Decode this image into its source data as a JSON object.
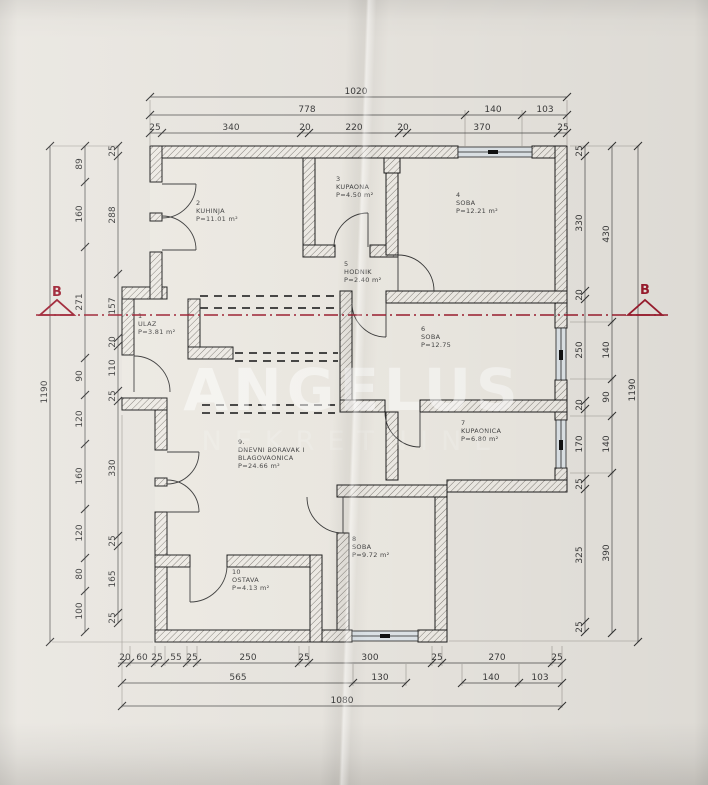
{
  "watermark": {
    "title": "ANGELUS",
    "subtitle": "NEKRETNINE"
  },
  "section": {
    "label_left": "B",
    "label_right": "B",
    "color": "#9c1c2e"
  },
  "rooms": [
    {
      "num": "1",
      "name": "ULAZ",
      "area": "P=3.81 m²",
      "x": 138,
      "y": 318
    },
    {
      "num": "2",
      "name": "KUHINJA",
      "area": "P=11.01 m²",
      "x": 196,
      "y": 205
    },
    {
      "num": "3",
      "name": "KUPAONA",
      "area": "P=4.50 m²",
      "x": 336,
      "y": 181
    },
    {
      "num": "4",
      "name": "SOBA",
      "area": "P=12.21 m²",
      "x": 456,
      "y": 197
    },
    {
      "num": "5",
      "name": "HODNIK",
      "area": "P=2.40 m²",
      "x": 344,
      "y": 266
    },
    {
      "num": "6",
      "name": "SOBA",
      "area": "P=12.75",
      "x": 421,
      "y": 331
    },
    {
      "num": "7",
      "name": "KUPAONICA",
      "area": "P=6.80 m²",
      "x": 461,
      "y": 425
    },
    {
      "num": "8",
      "name": "SOBA",
      "area": "P=9.72 m²",
      "x": 352,
      "y": 541
    },
    {
      "num": "9.",
      "name": "DNEVNI BORAVAK I",
      "name2": "BLAGOVAONICA",
      "area": "P=24.66 m²",
      "x": 238,
      "y": 444
    },
    {
      "num": "10",
      "name": "OSTAVA",
      "area": "P=4.13 m²",
      "x": 232,
      "y": 574
    }
  ],
  "dimensions": {
    "chains": [
      {
        "dir": "h",
        "axis": 97,
        "from": 150,
        "to": 567,
        "ticks": [
          150,
          567
        ],
        "labels": [
          {
            "t": "1020",
            "p": 356
          }
        ]
      },
      {
        "dir": "h",
        "axis": 115,
        "from": 150,
        "to": 567,
        "ticks": [
          150,
          465,
          522,
          567
        ],
        "labels": [
          {
            "t": "778",
            "p": 307
          },
          {
            "t": "140",
            "p": 493
          },
          {
            "t": "103",
            "p": 545
          }
        ]
      },
      {
        "dir": "h",
        "axis": 133,
        "from": 150,
        "to": 567,
        "ticks": [
          150,
          162,
          301,
          309,
          399,
          407,
          558,
          567
        ],
        "labels": [
          {
            "t": "25",
            "p": 155
          },
          {
            "t": "340",
            "p": 231
          },
          {
            "t": "20",
            "p": 305
          },
          {
            "t": "220",
            "p": 354
          },
          {
            "t": "20",
            "p": 403
          },
          {
            "t": "370",
            "p": 482
          },
          {
            "t": "25",
            "p": 563
          }
        ]
      },
      {
        "dir": "h",
        "axis": 663,
        "from": 118,
        "to": 562,
        "ticks": [
          122,
          130,
          155,
          165,
          187,
          197,
          299,
          309,
          432,
          442,
          552,
          562
        ],
        "labels": [
          {
            "t": "20",
            "p": 125
          },
          {
            "t": "60",
            "p": 142
          },
          {
            "t": "25",
            "p": 157
          },
          {
            "t": "55",
            "p": 176
          },
          {
            "t": "25",
            "p": 192
          },
          {
            "t": "250",
            "p": 248
          },
          {
            "t": "25",
            "p": 304
          },
          {
            "t": "300",
            "p": 370
          },
          {
            "t": "25",
            "p": 437
          },
          {
            "t": "270",
            "p": 497
          },
          {
            "t": "25",
            "p": 557
          }
        ]
      },
      {
        "dir": "h",
        "axis": 683,
        "from": 122,
        "to": 406,
        "ticks": [
          122,
          353,
          406
        ],
        "labels": [
          {
            "t": "565",
            "p": 238
          },
          {
            "t": "130",
            "p": 380
          }
        ]
      },
      {
        "dir": "h",
        "axis": 683,
        "from": 462,
        "to": 562,
        "ticks": [
          462,
          519,
          562
        ],
        "labels": [
          {
            "t": "140",
            "p": 491
          },
          {
            "t": "103",
            "p": 540
          }
        ]
      },
      {
        "dir": "h",
        "axis": 706,
        "from": 122,
        "to": 562,
        "ticks": [
          122,
          562
        ],
        "labels": [
          {
            "t": "1080",
            "p": 342
          }
        ]
      },
      {
        "dir": "v",
        "axis": 50,
        "from": 146,
        "to": 642,
        "ticks": [
          146,
          642
        ],
        "labels": [
          {
            "t": "1190",
            "p": 392
          }
        ]
      },
      {
        "dir": "v",
        "axis": 85,
        "from": 146,
        "to": 632,
        "ticks": [
          146,
          182,
          247,
          358,
          395,
          444,
          509,
          558,
          591,
          632
        ],
        "labels": [
          {
            "t": "89",
            "p": 164
          },
          {
            "t": "160",
            "p": 214
          },
          {
            "t": "271",
            "p": 302
          },
          {
            "t": "90",
            "p": 376
          },
          {
            "t": "120",
            "p": 419
          },
          {
            "t": "160",
            "p": 476
          },
          {
            "t": "120",
            "p": 533
          },
          {
            "t": "80",
            "p": 574
          },
          {
            "t": "100",
            "p": 611
          }
        ]
      },
      {
        "dir": "v",
        "axis": 118,
        "from": 146,
        "to": 623,
        "ticks": [
          146,
          156,
          274,
          338,
          346,
          391,
          401,
          536,
          546,
          613,
          623
        ],
        "labels": [
          {
            "t": "25",
            "p": 151
          },
          {
            "t": "288",
            "p": 215
          },
          {
            "t": "157",
            "p": 306
          },
          {
            "t": "20",
            "p": 342
          },
          {
            "t": "110",
            "p": 368
          },
          {
            "t": "25",
            "p": 396
          },
          {
            "t": "330",
            "p": 468
          },
          {
            "t": "25",
            "p": 541
          },
          {
            "t": "165",
            "p": 579
          },
          {
            "t": "25",
            "p": 618
          }
        ]
      },
      {
        "dir": "v",
        "axis": 585,
        "from": 146,
        "to": 632,
        "ticks": [
          146,
          156,
          291,
          299,
          401,
          409,
          479,
          489,
          622,
          632
        ],
        "labels": [
          {
            "t": "25",
            "p": 151
          },
          {
            "t": "330",
            "p": 223
          },
          {
            "t": "20",
            "p": 295
          },
          {
            "t": "250",
            "p": 350
          },
          {
            "t": "20",
            "p": 405
          },
          {
            "t": "170",
            "p": 444
          },
          {
            "t": "25",
            "p": 484
          },
          {
            "t": "325",
            "p": 555
          },
          {
            "t": "25",
            "p": 627
          }
        ]
      },
      {
        "dir": "v",
        "axis": 612,
        "from": 146,
        "to": 633,
        "ticks": [
          146,
          322,
          379,
          416,
          473,
          633
        ],
        "labels": [
          {
            "t": "430",
            "p": 234
          },
          {
            "t": "140",
            "p": 350
          },
          {
            "t": "90",
            "p": 397
          },
          {
            "t": "140",
            "p": 444
          },
          {
            "t": "390",
            "p": 553
          }
        ]
      },
      {
        "dir": "v",
        "axis": 638,
        "from": 146,
        "to": 642,
        "ticks": [
          146,
          642
        ],
        "labels": [
          {
            "t": "1190",
            "p": 390
          }
        ]
      }
    ]
  }
}
